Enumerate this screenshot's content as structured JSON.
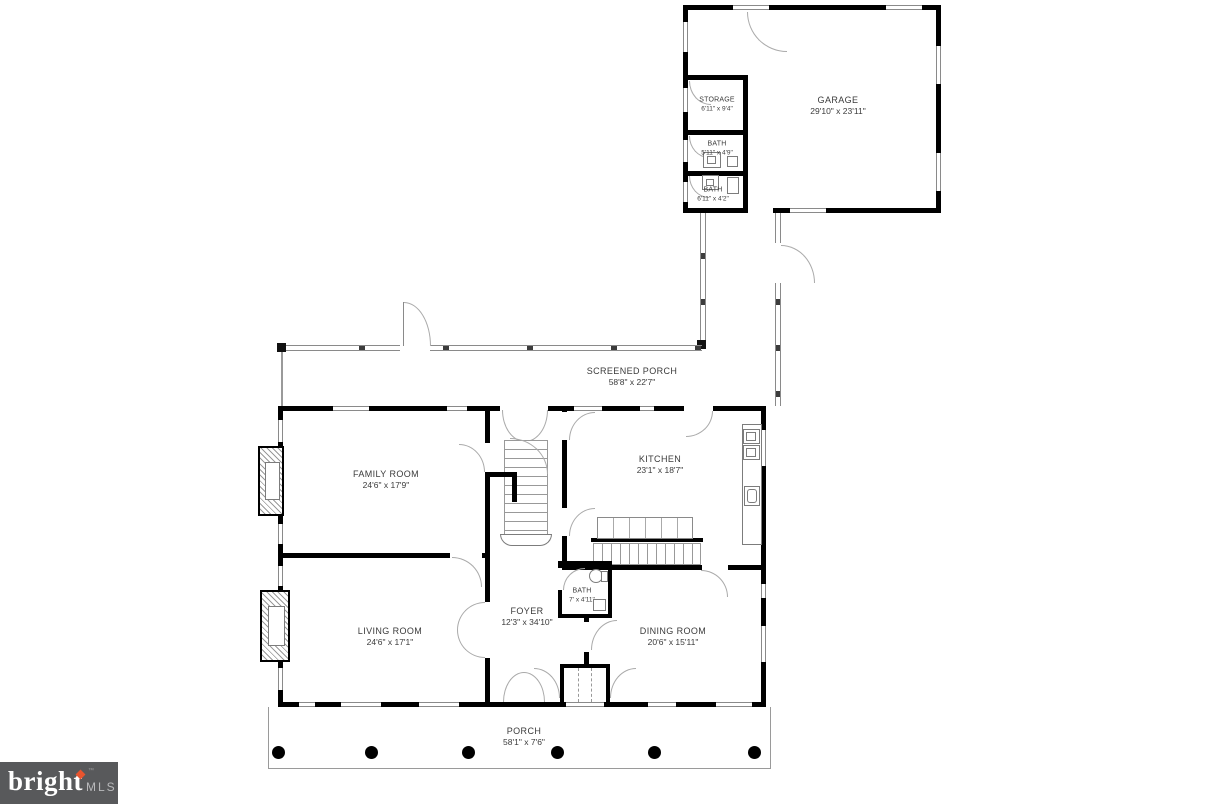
{
  "meta": {
    "type": "residential-floor-plan",
    "background": "#ffffff",
    "wall_color": "#000000",
    "line_color": "#9a9a9a",
    "text_color": "#3b3b3b"
  },
  "rooms": [
    {
      "id": "garage",
      "name": "GARAGE",
      "dims": "29'10\" x 23'11\""
    },
    {
      "id": "storage",
      "name": "STORAGE",
      "dims": "6'11\" x 9'4\""
    },
    {
      "id": "bath-garage-1",
      "name": "BATH",
      "dims": "5'11\" x 4'9\""
    },
    {
      "id": "bath-garage-2",
      "name": "BATH",
      "dims": "6'11\" x 4'2\""
    },
    {
      "id": "screened-porch",
      "name": "SCREENED PORCH",
      "dims": "58'8\" x 22'7\""
    },
    {
      "id": "family-room",
      "name": "FAMILY ROOM",
      "dims": "24'6\" x 17'9\""
    },
    {
      "id": "kitchen",
      "name": "KITCHEN",
      "dims": "23'1\" x 18'7\""
    },
    {
      "id": "foyer",
      "name": "FOYER",
      "dims": "12'3\" x 34'10\""
    },
    {
      "id": "living-room",
      "name": "LIVING ROOM",
      "dims": "24'6\" x 17'1\""
    },
    {
      "id": "bath-main",
      "name": "BATH",
      "dims": "7' x 4'11\""
    },
    {
      "id": "dining-room",
      "name": "DINING ROOM",
      "dims": "20'6\" x 15'11\""
    },
    {
      "id": "porch",
      "name": "PORCH",
      "dims": "58'1\" x 7'6\""
    }
  ],
  "watermark": {
    "brand": "bright",
    "suffix": "MLS",
    "tm": "™",
    "bg_color": "#58595b",
    "accent_color": "#e8542e",
    "mls_color": "#b9babc"
  }
}
